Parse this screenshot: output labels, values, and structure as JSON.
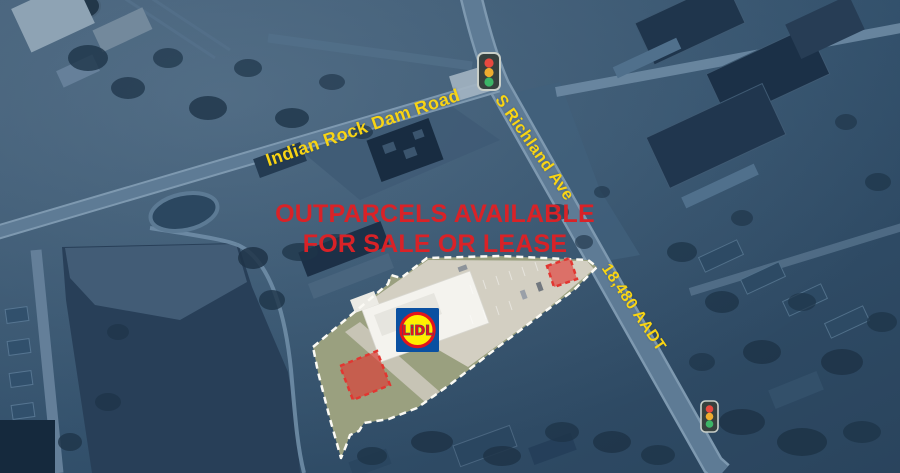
{
  "theme": {
    "base-tint": "#30506c",
    "label-yellow": "#f8d414",
    "headline-red": "#d92227",
    "parcel-line": "#fbfaf4",
    "outparcel-red": "#e23631",
    "signal-red": "#e8493f",
    "signal-amber": "#efac2f",
    "signal-green": "#3cb567",
    "lidl-blue": "#0a50a1",
    "lidl-yellow": "#ffef00",
    "lidl-red": "#e3141c"
  },
  "map": {
    "headline": {
      "line1": "OUTPARCELS AVAILABLE",
      "line2": "FOR SALE OR LEASE"
    },
    "road_labels": {
      "indian_rock": "Indian Rock Dam Road",
      "richland": "S Richland Ave"
    },
    "traffic_count": "18,480 AADT",
    "lidl_wordmark": "LiDL"
  }
}
